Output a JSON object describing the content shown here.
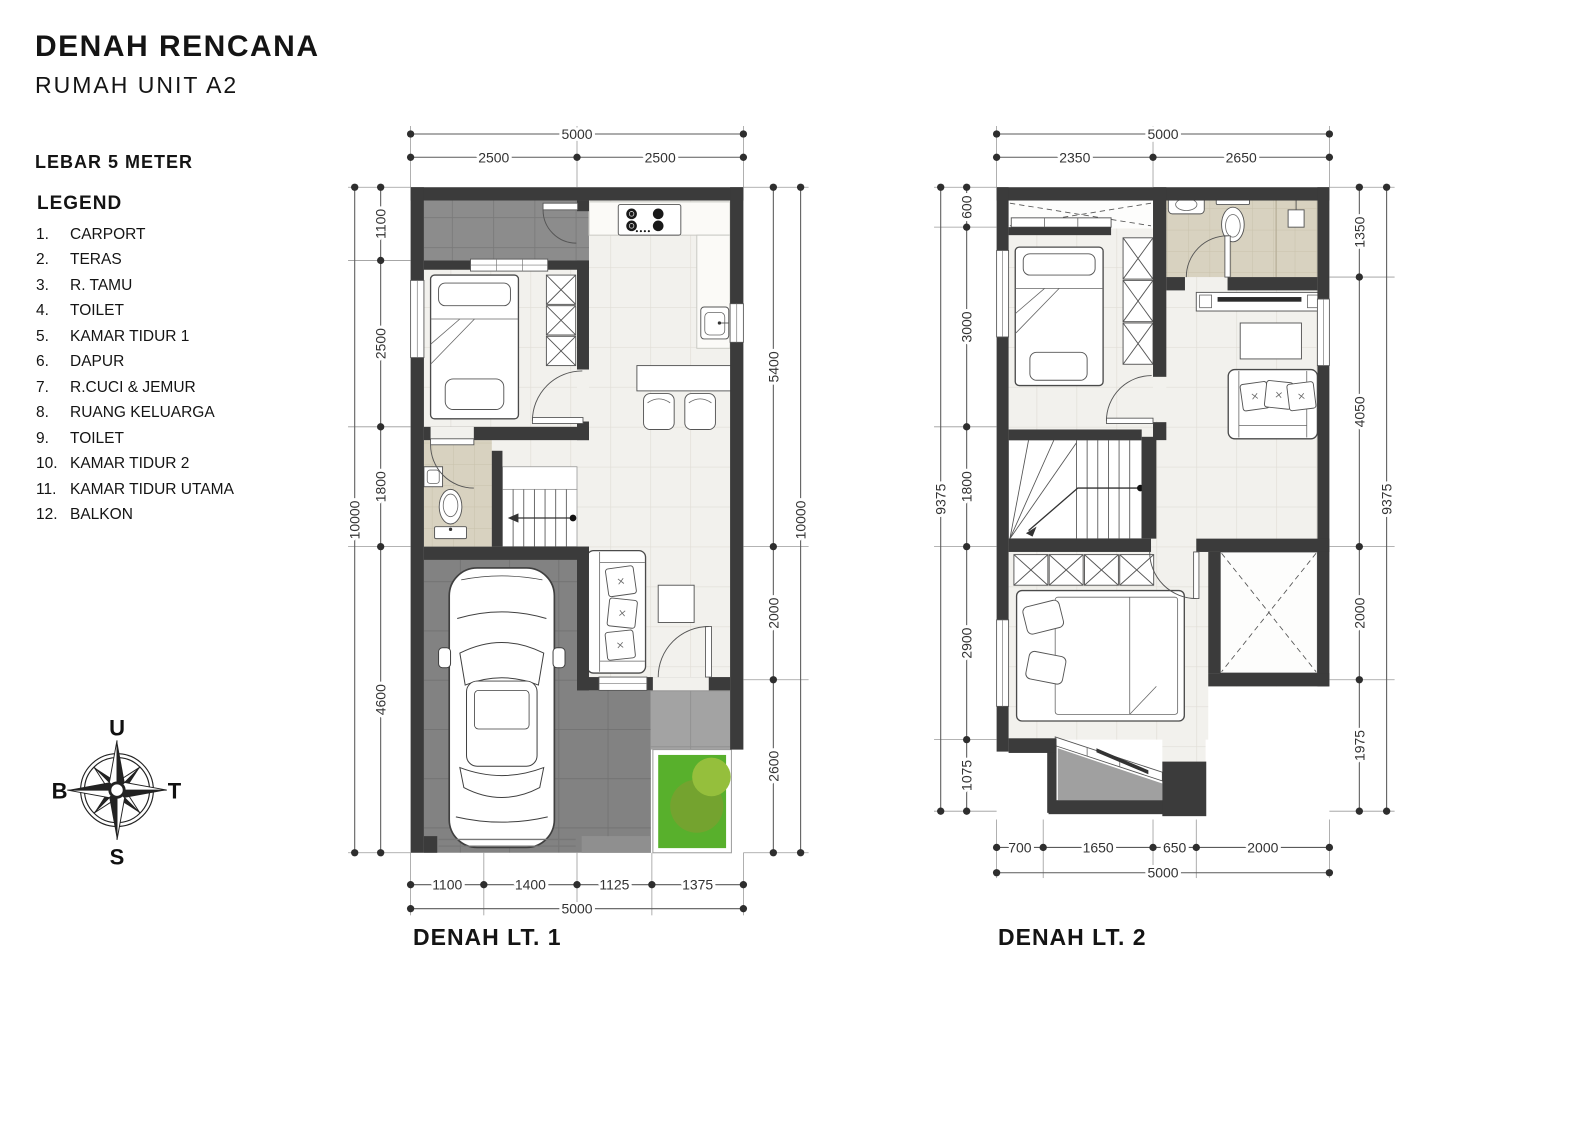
{
  "header": {
    "title": "DENAH RENCANA",
    "subtitle": "RUMAH UNIT A2",
    "width_label": "LEBAR 5 METER"
  },
  "legend": {
    "heading": "LEGEND",
    "items": [
      {
        "num": "1.",
        "label": "CARPORT"
      },
      {
        "num": "2.",
        "label": "TERAS"
      },
      {
        "num": "3.",
        "label": "R. TAMU"
      },
      {
        "num": "4.",
        "label": "TOILET"
      },
      {
        "num": "5.",
        "label": "KAMAR TIDUR 1"
      },
      {
        "num": "6.",
        "label": "DAPUR"
      },
      {
        "num": "7.",
        "label": "R.CUCI & JEMUR"
      },
      {
        "num": "8.",
        "label": "RUANG KELUARGA"
      },
      {
        "num": "9.",
        "label": "TOILET"
      },
      {
        "num": "10.",
        "label": "KAMAR TIDUR 2"
      },
      {
        "num": "11.",
        "label": "KAMAR TIDUR UTAMA"
      },
      {
        "num": "12.",
        "label": "BALKON"
      }
    ]
  },
  "compass": {
    "north": "U",
    "east": "T",
    "south": "S",
    "west": "B"
  },
  "plans": {
    "plan1": {
      "label": "DENAH LT. 1",
      "dims": {
        "top_total": [
          "5000"
        ],
        "top_chain": [
          "2500",
          "2500"
        ],
        "left_total": [
          "10000"
        ],
        "left_chain": [
          "1100",
          "2500",
          "1800",
          "4600"
        ],
        "right_chain": [
          "5400",
          "2000",
          "2600"
        ],
        "right_total": [
          "10000"
        ],
        "bottom_chain": [
          "1100",
          "1400",
          "1125",
          "1375"
        ],
        "bottom_total": [
          "5000"
        ]
      }
    },
    "plan2": {
      "label": "DENAH LT. 2",
      "dims": {
        "top_total": [
          "5000"
        ],
        "top_chain": [
          "2350",
          "2650"
        ],
        "left_total": [
          "9375"
        ],
        "left_chain": [
          "600",
          "3000",
          "1800",
          "2900",
          "1075"
        ],
        "right_chain": [
          "1350",
          "4050",
          "2000",
          "1975"
        ],
        "right_total": [
          "9375"
        ],
        "bottom_chain": [
          "700",
          "1650",
          "650",
          "2000"
        ],
        "bottom_total": [
          "5000"
        ]
      }
    }
  }
}
